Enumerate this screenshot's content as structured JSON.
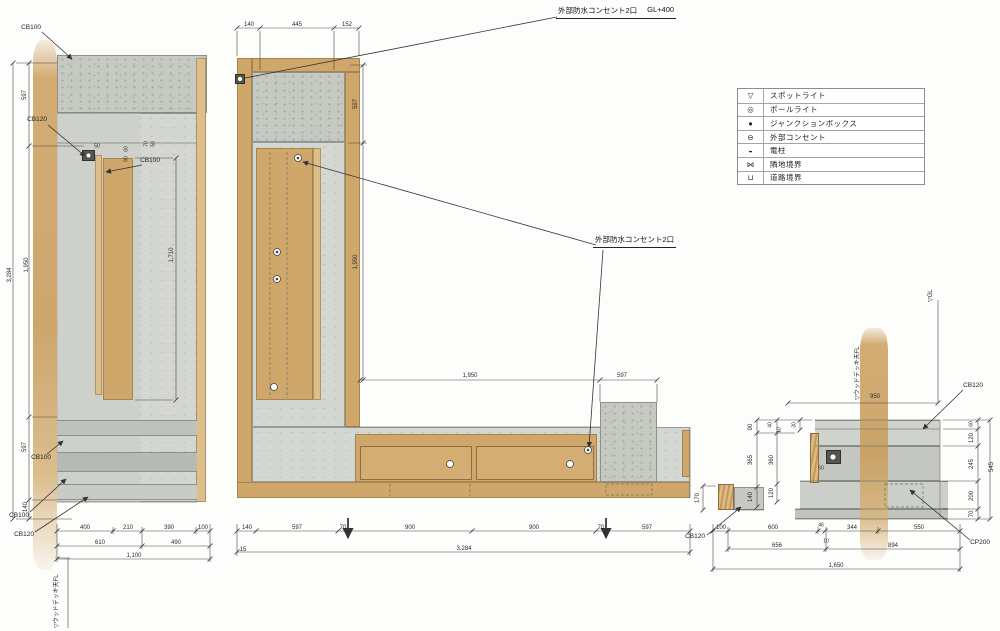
{
  "legend": {
    "rows": [
      {
        "symbol": "▽",
        "label": "スポットライト"
      },
      {
        "symbol": "◎",
        "label": "ポールライト"
      },
      {
        "symbol": "●",
        "label": "ジャンクションボックス"
      },
      {
        "symbol": "⊖",
        "label": "外部コンセント"
      },
      {
        "symbol": "◒",
        "label": "電柱"
      },
      {
        "symbol": "⋈",
        "label": "隣地境界"
      },
      {
        "symbol": "⊔",
        "label": "道路境界"
      }
    ]
  },
  "notes": {
    "outlet_top": "外部防水コンセント2口",
    "outlet_top_level": "GL+400",
    "outlet_mid": "外部防水コンセント2口",
    "deck_left": "▽ウッドデッキ天FL",
    "deck_right": "▽ウッドデッキ天FL",
    "gl_right": "▽GL"
  },
  "part_labels": {
    "cb100": "CB100",
    "cb120": "CB120",
    "cp200": "CP200"
  },
  "dims": {
    "left": {
      "v597t": "597",
      "v1950": "1,950",
      "v3284": "3,284",
      "v597b": "597",
      "v140": "140",
      "v1710": "1,710",
      "d50": "50",
      "d60": "60",
      "d90": "90",
      "d70": "70",
      "d50b": "50",
      "b400": "400",
      "b210": "210",
      "b390": "390",
      "b100": "100",
      "b610": "610",
      "b490": "490",
      "b1100": "1,100"
    },
    "mid": {
      "t140": "140",
      "t445": "445",
      "t152": "152",
      "r597": "597",
      "r1950": "1,950",
      "h1950": "1,950",
      "h597": "597",
      "b140": "140",
      "b597a": "597",
      "b70a": "70",
      "b900a": "900",
      "b900b": "900",
      "b70b": "70",
      "b597b": "597",
      "b15": "15",
      "b3284": "3,284"
    },
    "right": {
      "h950": "950",
      "a90": "90",
      "a365": "365",
      "a140": "140",
      "b40": "40",
      "b10": "10",
      "b360": "360",
      "b120": "120",
      "c30": "30",
      "s170": "170",
      "s50": "50",
      "r60": "60",
      "r120": "120",
      "r245": "245",
      "r200": "200",
      "r70": "70",
      "r545": "545",
      "w100": "100",
      "w600": "600",
      "w46": "46",
      "w344": "344",
      "w550": "550",
      "w10": "10",
      "w656": "656",
      "w894": "894",
      "w1650": "1,650"
    }
  }
}
